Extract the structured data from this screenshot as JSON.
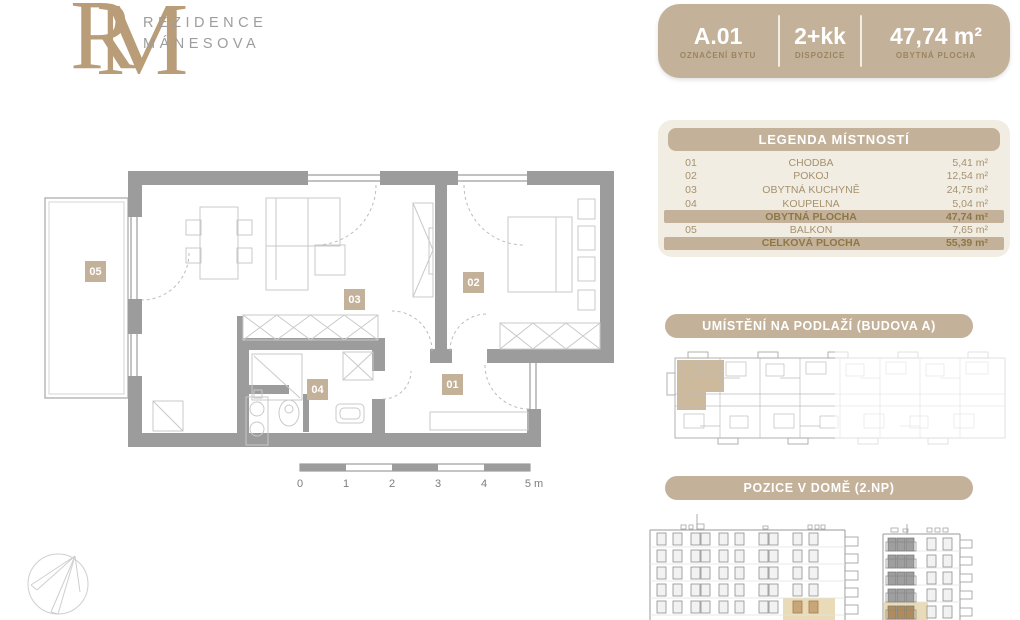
{
  "brand": {
    "monogram_r": "R",
    "monogram_m": "M",
    "name_line1": "REZIDENCE",
    "name_line2": "MÁNESOVA"
  },
  "header_badge": {
    "unit_value": "A.01",
    "unit_label": "OZNAČENÍ BYTU",
    "layout_value": "2+kk",
    "layout_label": "DISPOZICE",
    "area_value": "47,74 m²",
    "area_label": "OBYTNÁ PLOCHA"
  },
  "legend": {
    "title": "LEGENDA MÍSTNOSTÍ",
    "rows": [
      {
        "num": "01",
        "name": "CHODBA",
        "area": "5,41 m²"
      },
      {
        "num": "02",
        "name": "POKOJ",
        "area": "12,54 m²"
      },
      {
        "num": "03",
        "name": "OBYTNÁ KUCHYNĚ",
        "area": "24,75 m²"
      },
      {
        "num": "04",
        "name": "KOUPELNA",
        "area": "5,04 m²"
      }
    ],
    "summary_living": {
      "name": "OBYTNÁ PLOCHA",
      "area": "47,74 m²"
    },
    "balcony_row": {
      "num": "05",
      "name": "BALKON",
      "area": "7,65 m²"
    },
    "summary_total": {
      "name": "CELKOVÁ PLOCHA",
      "area": "55,39 m²"
    }
  },
  "sections": {
    "location_title": "UMÍSTĚNÍ NA PODLAŽÍ (BUDOVA A)",
    "position_title": "POZICE V DOMĚ (2.NP)"
  },
  "floor_plan": {
    "room_labels": {
      "hall": "01",
      "bedroom": "02",
      "living": "03",
      "bath": "04",
      "balcony": "05"
    },
    "scale_labels": [
      "0",
      "1",
      "2",
      "3",
      "4",
      "5 m"
    ]
  },
  "colors": {
    "tan": "#c3b199",
    "panel_bg": "#f2ede3",
    "gold_text": "#a5916c",
    "gold_dark": "#8e7747",
    "wall_gray": "#9c9c9c",
    "highlight": "#e9dab8"
  }
}
